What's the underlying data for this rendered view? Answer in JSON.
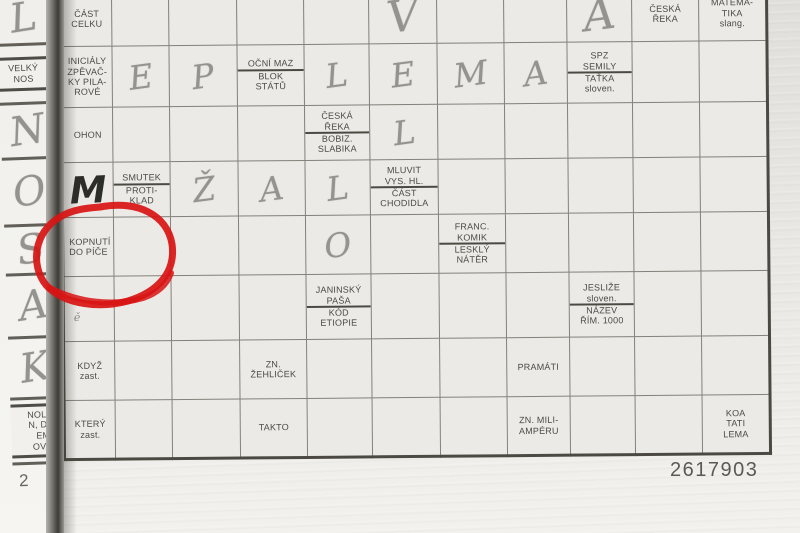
{
  "photo": {
    "puzzle_number": "2617903",
    "page_number_fragment": "2"
  },
  "colors": {
    "annotation_red": "#d81414",
    "shaded_cell": "#c9c8c3",
    "grid_line": "#4b4942"
  },
  "left_strip": {
    "cells": [
      {
        "t": "p",
        "ch": "L",
        "h": 50
      },
      {
        "t": "clue",
        "lines": [
          "VELKÝ",
          "NOS"
        ],
        "h": 56
      },
      {
        "t": "p",
        "ch": "N",
        "h": 52
      },
      {
        "t": "p",
        "ch": "O",
        "h": 64
      },
      {
        "t": "p",
        "ch": "S",
        "h": 46
      },
      {
        "t": "p",
        "ch": "A",
        "h": 60
      },
      {
        "t": "p",
        "ch": "K",
        "h": 58
      },
      {
        "t": "clue",
        "lines": [
          "NOLÍN",
          "N, DIE",
          "EMA",
          "OVAT"
        ],
        "h": 62,
        "align": "right"
      },
      {
        "t": "num",
        "ch": "2",
        "h": 34
      }
    ]
  },
  "layout": {
    "col_widths": [
      51,
      57,
      68,
      67,
      65,
      68,
      67,
      63,
      65,
      67,
      68
    ],
    "row_heights": [
      56,
      61,
      55,
      55,
      59,
      65,
      59,
      59
    ]
  },
  "grid": {
    "rows": [
      [
        {
          "t": "clue",
          "lines": [
            "ČÁST",
            "CELKU"
          ]
        },
        {
          "t": "e"
        },
        {
          "t": "e",
          "sh": true
        },
        {
          "t": "e"
        },
        {
          "t": "e"
        },
        {
          "t": "p",
          "ch": "V",
          "big": true
        },
        {
          "t": "e"
        },
        {
          "t": "e"
        },
        {
          "t": "p",
          "ch": "A",
          "big": true
        },
        {
          "t": "clue",
          "lines": [
            "ČESKÁ",
            "ŘEKA"
          ]
        },
        {
          "t": "clue",
          "lines": [
            "MATEMA-",
            "TIKA",
            "slang."
          ]
        }
      ],
      [
        {
          "t": "clue",
          "lines": [
            "INICIÁLY",
            "ZPĚVAČ-",
            "KY PILA-",
            "ROVÉ"
          ]
        },
        {
          "t": "p",
          "ch": "E"
        },
        {
          "t": "p",
          "ch": "P",
          "sh": true
        },
        {
          "t": "clue2",
          "top": [
            "OČNÍ MAZ"
          ],
          "bot": [
            "BLOK",
            "STÁTŮ"
          ]
        },
        {
          "t": "p",
          "ch": "L"
        },
        {
          "t": "p",
          "ch": "E"
        },
        {
          "t": "p",
          "ch": "M"
        },
        {
          "t": "p",
          "ch": "A"
        },
        {
          "t": "clue2",
          "top": [
            "SPZ",
            "SEMILY"
          ],
          "bot": [
            "TAŤKA",
            "sloven."
          ]
        },
        {
          "t": "e"
        },
        {
          "t": "e"
        }
      ],
      [
        {
          "t": "clue",
          "lines": [
            "OHON"
          ]
        },
        {
          "t": "e"
        },
        {
          "t": "e",
          "sh": true
        },
        {
          "t": "e"
        },
        {
          "t": "clue2",
          "top": [
            "ČESKÁ",
            "ŘEKA"
          ],
          "bot": [
            "BOBIZ.",
            "SLABIKA"
          ]
        },
        {
          "t": "p",
          "ch": "L"
        },
        {
          "t": "e"
        },
        {
          "t": "e"
        },
        {
          "t": "e"
        },
        {
          "t": "e"
        },
        {
          "t": "e"
        }
      ],
      [
        {
          "t": "ink",
          "ch": "M"
        },
        {
          "t": "clue2",
          "top": [
            "SMUTEK"
          ],
          "bot": [
            "PROTI-",
            "KLAD"
          ]
        },
        {
          "t": "p",
          "ch": "Ž",
          "sh": true
        },
        {
          "t": "p",
          "ch": "A"
        },
        {
          "t": "p",
          "ch": "L"
        },
        {
          "t": "clue2",
          "top": [
            "MLUVIT",
            "VYS. HL."
          ],
          "bot": [
            "ČÁST",
            "CHODIDLA"
          ]
        },
        {
          "t": "e"
        },
        {
          "t": "e"
        },
        {
          "t": "e"
        },
        {
          "t": "e"
        },
        {
          "t": "e"
        }
      ],
      [
        {
          "t": "clue",
          "lines": [
            "KOPNUTÍ",
            "DO PÍČE"
          ],
          "align": "left",
          "circled": true
        },
        {
          "t": "e"
        },
        {
          "t": "e",
          "sh": true
        },
        {
          "t": "e"
        },
        {
          "t": "p",
          "ch": "O"
        },
        {
          "t": "e"
        },
        {
          "t": "clue2",
          "top": [
            "FRANC.",
            "KOMIK"
          ],
          "bot": [
            "LESKLÝ",
            "NÁTĚR"
          ]
        },
        {
          "t": "e"
        },
        {
          "t": "e"
        },
        {
          "t": "e"
        },
        {
          "t": "e"
        }
      ],
      [
        {
          "t": "mark",
          "ch": "ě"
        },
        {
          "t": "e"
        },
        {
          "t": "e",
          "sh": true
        },
        {
          "t": "e"
        },
        {
          "t": "clue2",
          "top": [
            "JANINSKÝ",
            "PAŠA"
          ],
          "bot": [
            "KÓD",
            "ETIOPIE"
          ]
        },
        {
          "t": "e"
        },
        {
          "t": "e"
        },
        {
          "t": "e"
        },
        {
          "t": "clue2",
          "top": [
            "JESLIŽE",
            "sloven."
          ],
          "bot": [
            "NÁZEV",
            "ŘÍM. 1000"
          ]
        },
        {
          "t": "e"
        },
        {
          "t": "e"
        }
      ],
      [
        {
          "t": "clue",
          "lines": [
            "KDYŽ",
            "zast."
          ]
        },
        {
          "t": "e"
        },
        {
          "t": "e",
          "sh": true
        },
        {
          "t": "clue",
          "lines": [
            "ZN.",
            "ŽEHLIČEK"
          ]
        },
        {
          "t": "e"
        },
        {
          "t": "e"
        },
        {
          "t": "e"
        },
        {
          "t": "clue",
          "lines": [
            "PRAMÁTI"
          ]
        },
        {
          "t": "e"
        },
        {
          "t": "e"
        },
        {
          "t": "e"
        }
      ],
      [
        {
          "t": "clue",
          "lines": [
            "KTERÝ",
            "zast."
          ]
        },
        {
          "t": "e"
        },
        {
          "t": "e",
          "sh": true
        },
        {
          "t": "clue",
          "lines": [
            "TAKTO"
          ]
        },
        {
          "t": "e"
        },
        {
          "t": "e"
        },
        {
          "t": "e"
        },
        {
          "t": "clue",
          "lines": [
            "ZN. MILI-",
            "AMPÉRU"
          ]
        },
        {
          "t": "e"
        },
        {
          "t": "e"
        },
        {
          "t": "clue",
          "lines": [
            "KOA",
            "TATI",
            "LEMA"
          ]
        }
      ]
    ]
  }
}
